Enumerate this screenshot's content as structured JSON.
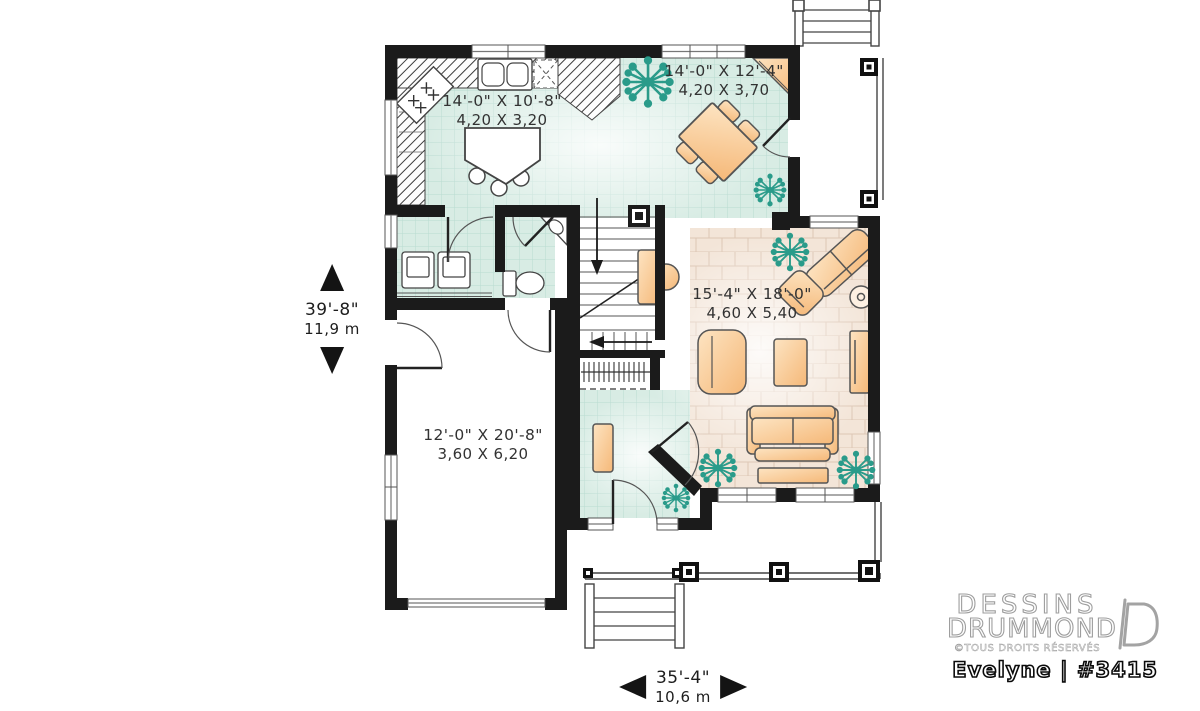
{
  "plan": {
    "rooms": {
      "kitchen": {
        "imperial": "14'-0\" X 10'-8\"",
        "metric": "4,20 X 3,20"
      },
      "dining": {
        "imperial": "14'-0\" X 12'-4\"",
        "metric": "4,20 X 3,70"
      },
      "living": {
        "imperial": "15'-4\" X 18'-0\"",
        "metric": "4,60 X 5,40"
      },
      "garage": {
        "imperial": "12'-0\" X 20'-8\"",
        "metric": "3,60 X 6,20"
      }
    },
    "overall": {
      "depth": {
        "imperial": "39'-8\"",
        "metric": "11,9 m"
      },
      "width": {
        "imperial": "35'-4\"",
        "metric": "10,6 m"
      }
    }
  },
  "branding": {
    "brand_line1": "DESSINS",
    "brand_line2": "DRUMMOND",
    "rights": "©TOUS DROITS RÉSERVÉS",
    "plan_name": "Evelyne | #3415"
  },
  "icons": {
    "dim_vertical": [
      "arrow-up",
      "arrow-down"
    ],
    "dim_horizontal": [
      "arrow-left",
      "arrow-right"
    ],
    "brand_mark": "drummond-d-logo"
  },
  "colors": {
    "wall": "#1b1b1b",
    "tile_floor": "#d8ece4",
    "tile_grid": "#b9dbd1",
    "wood_floor": "#f3e5d8",
    "furniture": "#f7c289",
    "plant": "#2a9b8a",
    "window_line": "#777777"
  }
}
